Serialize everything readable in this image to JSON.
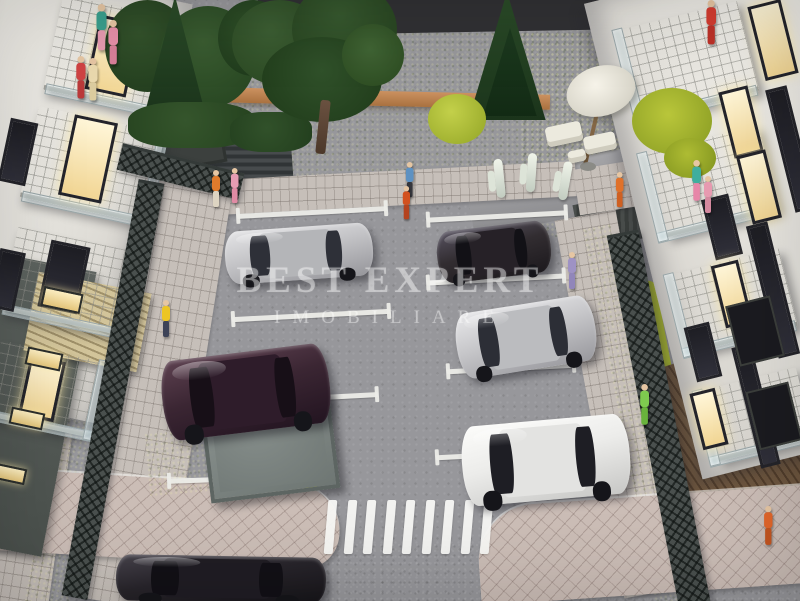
{
  "meta": {
    "description": "Photograph of a miniature architectural scale model: residential courtyard parking lot between two white apartment buildings, with toy cars, figurines, lawns, trees, lattice fences and a zebra crosswalk."
  },
  "watermark": {
    "line1": "BEST EXPERT",
    "line2": "IMOBILIARE",
    "color": "rgba(255,255,255,0.40)"
  },
  "palette": {
    "asphalt": "#96969a",
    "street": "#76767a",
    "paver": "#c6bfb9",
    "paver_pink": "#cbbdb6",
    "grass": "#9aa23f",
    "lime_bush": "#b9c63a",
    "foliage": "#2e4f28",
    "conifer": "#22421f",
    "terracotta_wall": "#c08552",
    "lattice_fence": "#4a504e",
    "facade_white": "#e9e7e1",
    "base_building": "#575d59",
    "lit_window": "#ffedc0",
    "dark_window": "#232327",
    "parking_line": "#ececе8",
    "wood_deck": "#64503c",
    "pergola_wood": "#cfc096"
  },
  "parking_lines": [
    {
      "x": 237,
      "y": 210,
      "len": 150,
      "rot": -3
    },
    {
      "x": 232,
      "y": 313,
      "len": 158,
      "rot": -3
    },
    {
      "x": 228,
      "y": 396,
      "len": 150,
      "rot": -3
    },
    {
      "x": 168,
      "y": 476,
      "len": 162,
      "rot": -2
    },
    {
      "x": 427,
      "y": 214,
      "len": 140,
      "rot": -3
    },
    {
      "x": 427,
      "y": 277,
      "len": 138,
      "rot": -3
    },
    {
      "x": 447,
      "y": 366,
      "len": 128,
      "rot": -3
    },
    {
      "x": 436,
      "y": 452,
      "len": 128,
      "rot": -3
    }
  ],
  "cars": [
    {
      "name": "silver-sedan-upper-left",
      "x": 225,
      "y": 227,
      "w": 148,
      "h": 53,
      "rot": -4,
      "light": "#e4e4e6",
      "body": "#c3c3c6",
      "dark": "#95959a",
      "cabin": "#b4b5b8",
      "glass": "#2e3038"
    },
    {
      "name": "black-sedan-upper-right",
      "x": 437,
      "y": 226,
      "w": 114,
      "h": 52,
      "rot": -7,
      "light": "#575260",
      "body": "#322d31",
      "dark": "#1c191d",
      "cabin": "#262127",
      "glass": "#121116"
    },
    {
      "name": "silver-sedan-right",
      "x": 456,
      "y": 304,
      "w": 140,
      "h": 66,
      "rot": -9,
      "light": "#e8e8ea",
      "body": "#c6c6c9",
      "dark": "#98989d",
      "cabin": "#bbbcbf",
      "glass": "#2c2e36"
    },
    {
      "name": "white-sedan-lower-right",
      "x": 462,
      "y": 420,
      "w": 168,
      "h": 80,
      "rot": -5,
      "light": "#fcfcfa",
      "body": "#ececea",
      "dark": "#c7c7c5",
      "cabin": "#e3e3e1",
      "glass": "#1e1e24"
    },
    {
      "name": "purple-sedan-left",
      "x": 162,
      "y": 352,
      "w": 168,
      "h": 80,
      "rot": -7,
      "light": "#5d4150",
      "body": "#3b2633",
      "dark": "#221420",
      "cabin": "#2e1c2a",
      "glass": "#170f17"
    },
    {
      "name": "dark-car-street",
      "x": 116,
      "y": 556,
      "w": 210,
      "h": 46,
      "rot": 1,
      "light": "#47434c",
      "body": "#28252b",
      "dark": "#161419",
      "cabin": "#201d24",
      "glass": "#121016"
    }
  ],
  "figures": [
    {
      "name": "figure-orange-shirt-top-left",
      "x": 210,
      "y": 170,
      "shirt": "#e07b2c",
      "pants": "#ddd4c2",
      "s": 1
    },
    {
      "name": "figure-pink-dress-top-left",
      "x": 229,
      "y": 168,
      "shirt": "#e59cb2",
      "pants": "#e08ba4",
      "s": 0.95
    },
    {
      "name": "figure-yellow-jacket-left",
      "x": 160,
      "y": 300,
      "shirt": "#ecc525",
      "pants": "#3c4257",
      "s": 1
    },
    {
      "name": "figure-blue-shirt-top",
      "x": 404,
      "y": 162,
      "shirt": "#5d91c2",
      "pants": "#35363c",
      "s": 0.95
    },
    {
      "name": "figure-red-walker-top",
      "x": 401,
      "y": 186,
      "shirt": "#d2511f",
      "pants": "#b4431f",
      "s": 0.9
    },
    {
      "name": "figure-purple-right-sidewalk",
      "x": 566,
      "y": 252,
      "shirt": "#9e92c4",
      "pants": "#9186ba",
      "s": 1
    },
    {
      "name": "figure-orange-right-path",
      "x": 614,
      "y": 172,
      "shirt": "#e0712a",
      "pants": "#cf6022",
      "s": 0.95
    },
    {
      "name": "figure-teal-right",
      "x": 690,
      "y": 160,
      "shirt": "#3fae9e",
      "pants": "#e786a8",
      "s": 1.1
    },
    {
      "name": "figure-pink-right",
      "x": 702,
      "y": 176,
      "shirt": "#e79ab0",
      "pants": "#d4899f",
      "s": 1
    },
    {
      "name": "figure-green-right-fence",
      "x": 638,
      "y": 384,
      "shirt": "#7ecb4f",
      "pants": "#69b33c",
      "s": 1.1
    },
    {
      "name": "figure-orange-bottom-corner",
      "x": 762,
      "y": 506,
      "shirt": "#e2662a",
      "pants": "#c45520",
      "s": 1.05
    },
    {
      "name": "figure-red-right-balcony",
      "x": 704,
      "y": 0,
      "shirt": "#d43c30",
      "pants": "#bd3128",
      "s": 1.2
    },
    {
      "name": "figure-teal-left-balcony",
      "x": 94,
      "y": 4,
      "shirt": "#3aa08e",
      "pants": "#e79ab0",
      "s": 1.25
    },
    {
      "name": "figure-pink-left-balcony",
      "x": 106,
      "y": 20,
      "shirt": "#e78fa8",
      "pants": "#d87f98",
      "s": 1.2
    },
    {
      "name": "figure-red-left-window",
      "x": 74,
      "y": 56,
      "shirt": "#d04343",
      "pants": "#bb3a3a",
      "s": 1.15
    },
    {
      "name": "figure-cream-left-window",
      "x": 86,
      "y": 58,
      "shirt": "#ead9ae",
      "pants": "#dccc9f",
      "s": 1.15
    }
  ],
  "crosswalk": {
    "x": 326,
    "y": 500,
    "h": 54,
    "count": 9,
    "stripe_w": 9,
    "gap": 10.5,
    "skew": -5
  },
  "buildings": {
    "left": {
      "rot": 12,
      "balconies": [
        {
          "x": 52,
          "y": 6,
          "w": 118,
          "h": 92
        },
        {
          "x": 28,
          "y": 118,
          "w": 124,
          "h": 88
        },
        {
          "x": 8,
          "y": 238,
          "w": 116,
          "h": 80
        },
        {
          "x": -8,
          "y": 350,
          "w": 102,
          "h": 72
        }
      ],
      "windows": [
        {
          "x": 92,
          "y": 18,
          "w": 36,
          "h": 70,
          "lit": true
        },
        {
          "x": 66,
          "y": 118,
          "w": 38,
          "h": 76,
          "lit": true
        },
        {
          "x": 44,
          "y": 243,
          "w": 34,
          "h": 62,
          "lit": false
        },
        {
          "x": 24,
          "y": 358,
          "w": 30,
          "h": 55,
          "lit": true
        },
        {
          "x": 4,
          "y": 120,
          "w": 22,
          "h": 58,
          "lit": false
        },
        {
          "x": -6,
          "y": 250,
          "w": 20,
          "h": 54,
          "lit": false
        }
      ],
      "base_windows": [
        {
          "x": 42,
          "y": 290,
          "w": 36,
          "h": 16
        },
        {
          "x": 26,
          "y": 350,
          "w": 32,
          "h": 14
        },
        {
          "x": 10,
          "y": 410,
          "w": 30,
          "h": 13
        },
        {
          "x": -6,
          "y": 466,
          "w": 28,
          "h": 12
        }
      ]
    },
    "right": {
      "rot": -14,
      "balconies": [
        {
          "x": 630,
          "y": 14,
          "w": 120,
          "h": 88
        },
        {
          "x": 654,
          "y": 138,
          "w": 116,
          "h": 82
        },
        {
          "x": 680,
          "y": 260,
          "w": 110,
          "h": 76
        },
        {
          "x": 708,
          "y": 378,
          "w": 98,
          "h": 68
        }
      ],
      "windows": [
        {
          "x": 756,
          "y": 2,
          "w": 28,
          "h": 70,
          "lit": true
        },
        {
          "x": 726,
          "y": 88,
          "w": 24,
          "h": 62,
          "lit": true
        },
        {
          "x": 744,
          "y": 152,
          "w": 24,
          "h": 64,
          "lit": true
        },
        {
          "x": 708,
          "y": 196,
          "w": 22,
          "h": 56,
          "lit": false
        },
        {
          "x": 718,
          "y": 262,
          "w": 22,
          "h": 58,
          "lit": true
        },
        {
          "x": 690,
          "y": 324,
          "w": 20,
          "h": 50,
          "lit": false
        },
        {
          "x": 696,
          "y": 390,
          "w": 20,
          "h": 52,
          "lit": true
        },
        {
          "x": 780,
          "y": 86,
          "w": 16,
          "h": 120,
          "lit": false
        },
        {
          "x": 762,
          "y": 222,
          "w": 16,
          "h": 130,
          "lit": false
        },
        {
          "x": 746,
          "y": 344,
          "w": 14,
          "h": 118,
          "lit": false
        }
      ],
      "base_windows": [
        {
          "x": 732,
          "y": 300,
          "w": 42,
          "h": 58
        },
        {
          "x": 752,
          "y": 386,
          "w": 40,
          "h": 56
        }
      ]
    }
  }
}
